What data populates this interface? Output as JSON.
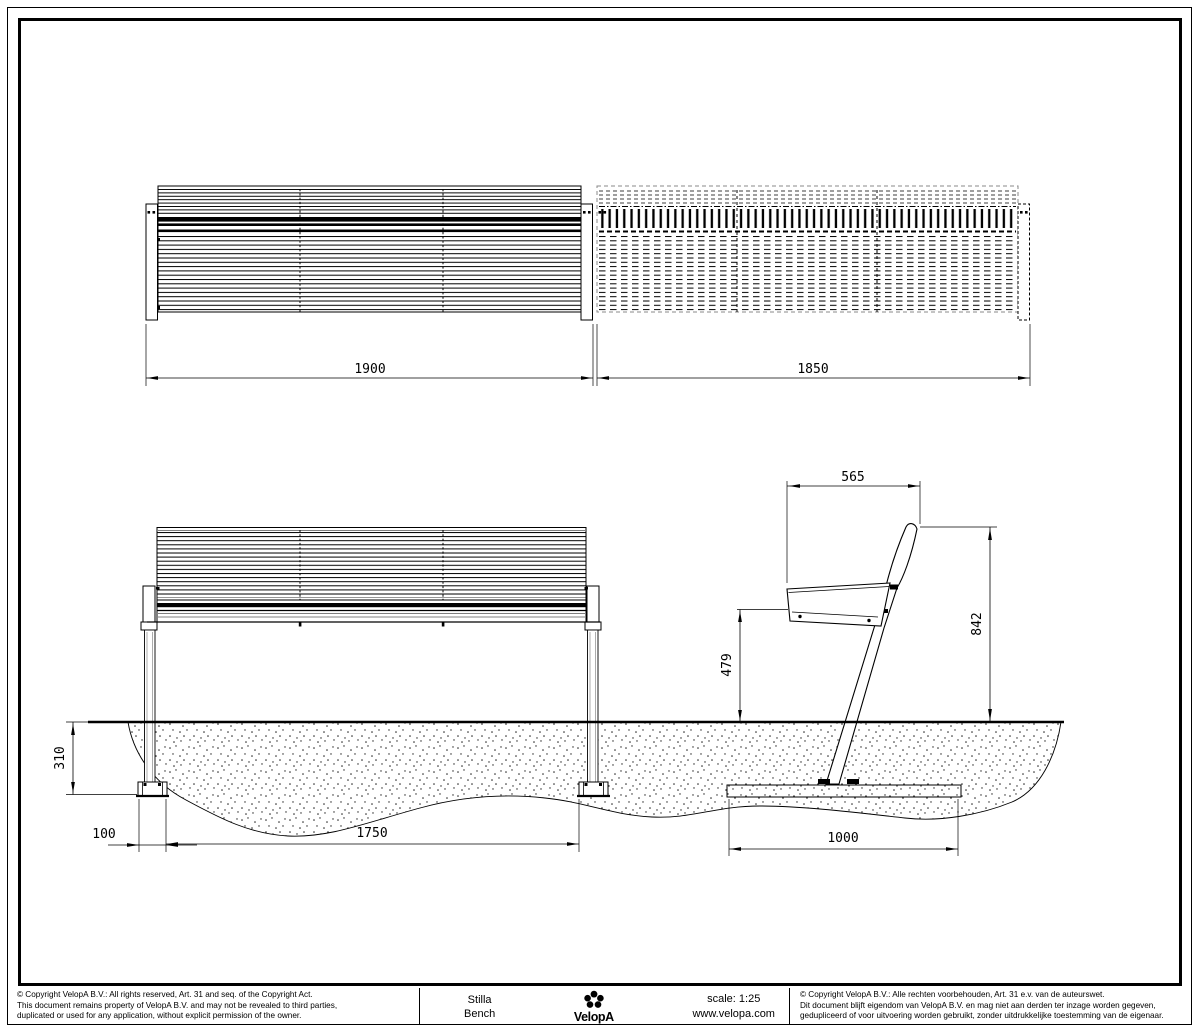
{
  "drawing": {
    "dimensions": {
      "bench_length": "1900",
      "bench_ghost_length": "1850",
      "seat_depth": "565",
      "back_height": "842",
      "seat_height": "479",
      "anchor_depth": "310",
      "foot_width": "100",
      "leg_spacing": "1750",
      "anchor_plate_length": "1000"
    }
  },
  "title_block": {
    "product": {
      "line1": "Stilla",
      "line2": "Bench"
    },
    "brand": "VelopA",
    "scale": "scale: 1:25",
    "website": "www.velopa.com",
    "copyright_en": {
      "line1": "© Copyright VelopA B.V.: All rights reserved, Art. 31 and seq. of the Copyright Act.",
      "line2": "This document remains property of VelopA B.V. and may not be revealed to third parties,",
      "line3": "duplicated or used for any application, without explicit permission of the owner."
    },
    "copyright_nl": {
      "line1": "© Copyright VelopA B.V.: Alle rechten voorbehouden, Art. 31 e.v. van de auteurswet.",
      "line2": "Dit document blijft eigendom van VelopA B.V. en mag niet aan derden ter inzage worden gegeven,",
      "line3": "gedupliceerd of voor uitvoering worden gebruikt, zonder uitdrukkelijke toestemming van de eigenaar."
    }
  },
  "colors": {
    "line": "#000000",
    "gray_line": "#808080",
    "background": "#ffffff"
  }
}
